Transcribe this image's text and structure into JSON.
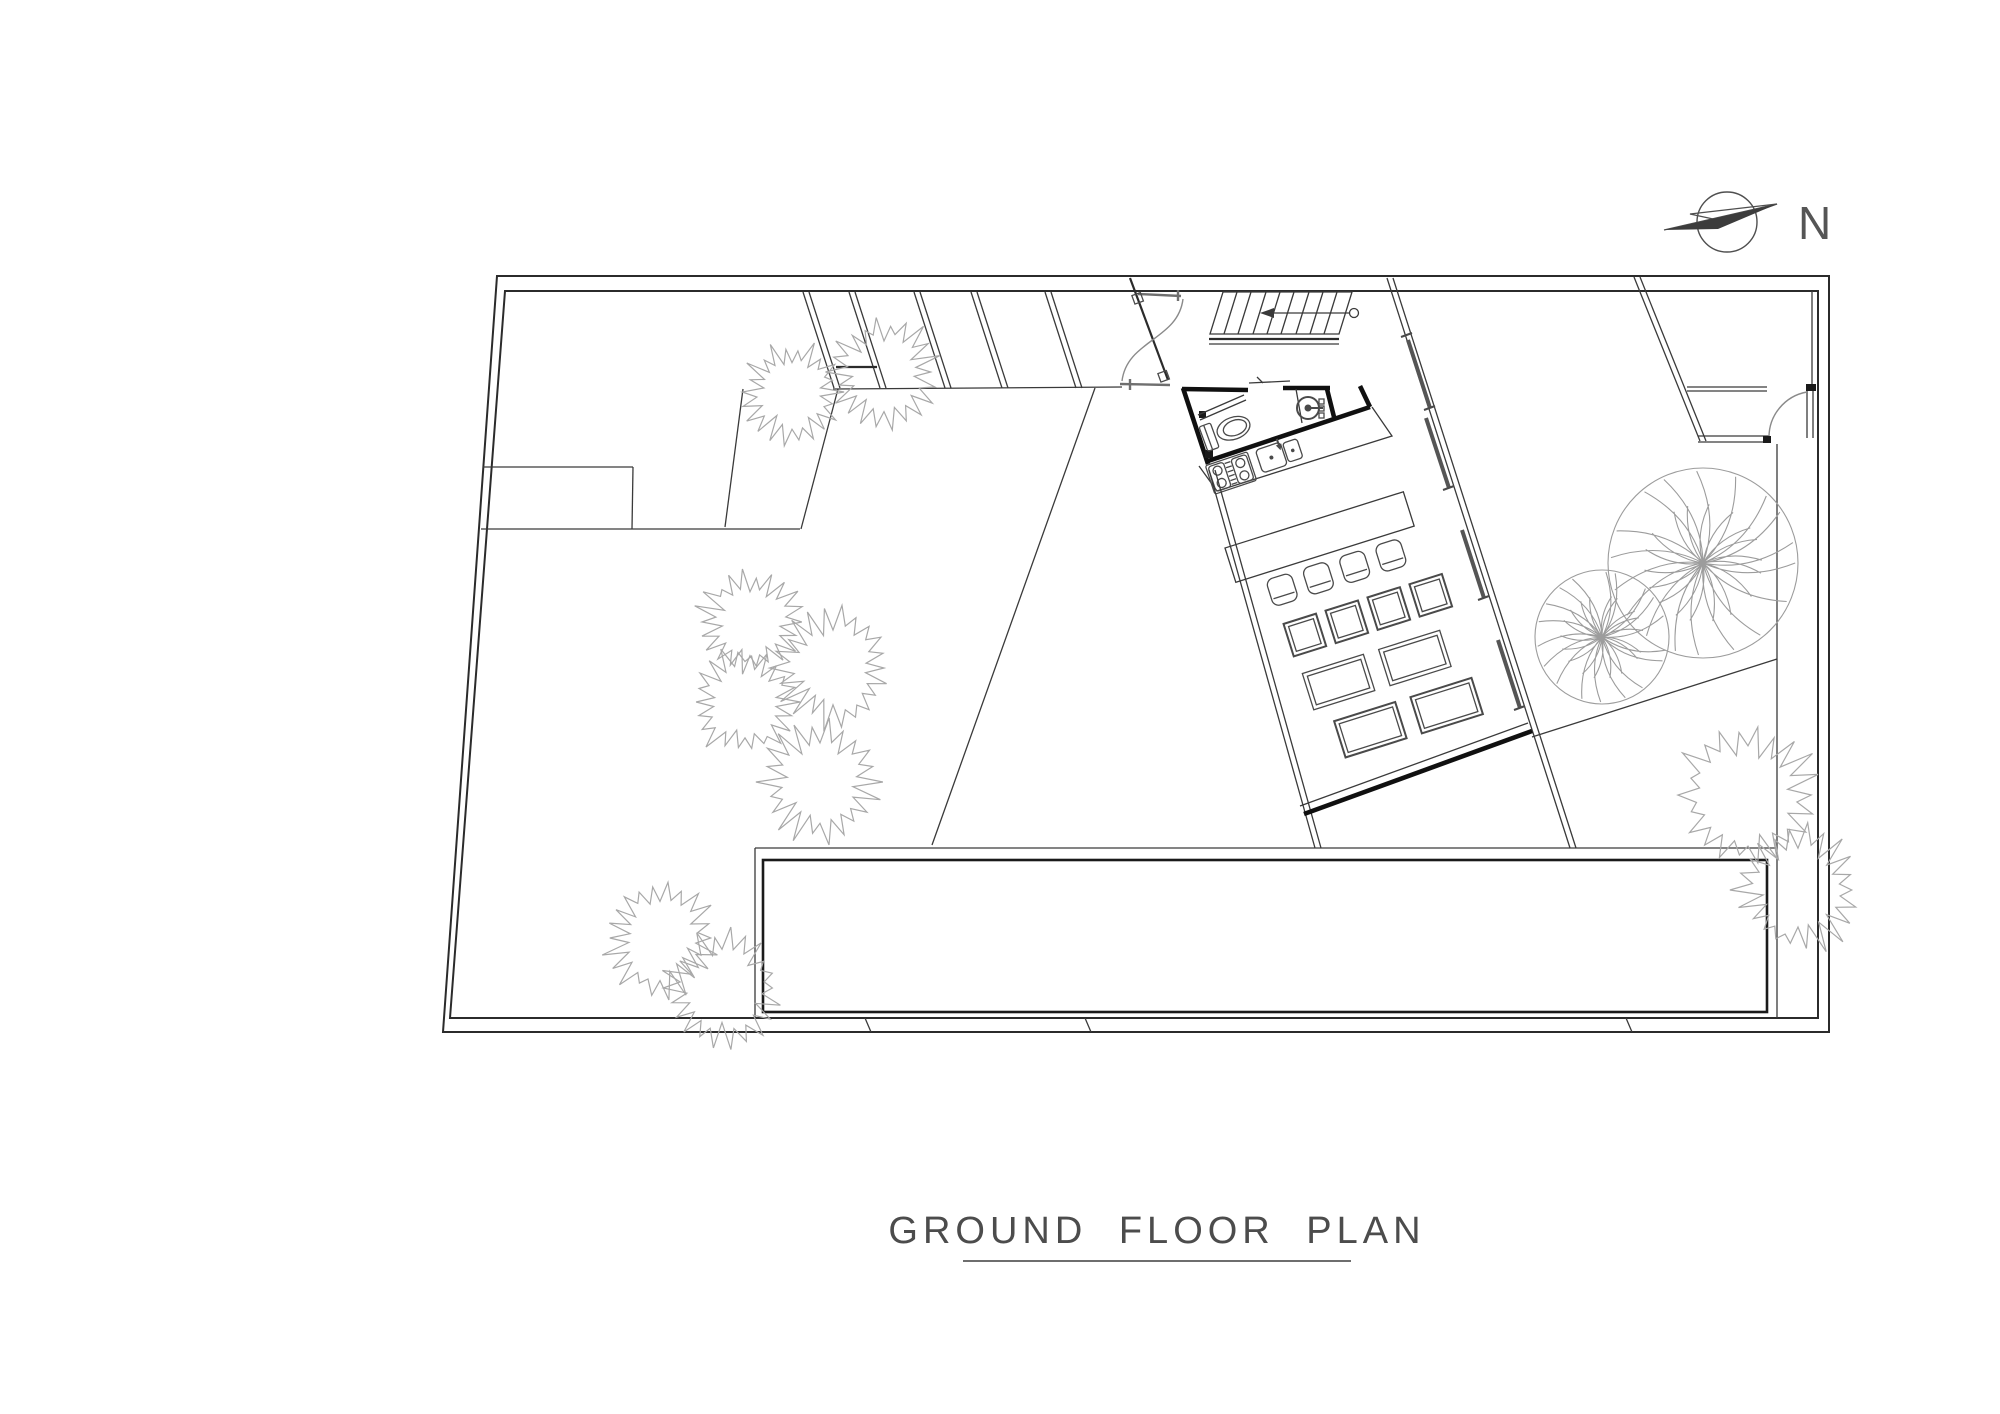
{
  "document": {
    "kind": "architectural floor plan drawing",
    "background_color": "#ffffff",
    "ink_color": "#2b2b2b",
    "heavy_wall_color": "#101010",
    "vegetation_color": "#a8a8a8"
  },
  "title": {
    "text": "GROUND FLOOR PLAN",
    "underlined": true
  },
  "compass": {
    "label": "N",
    "direction": "arrow points left of the N label"
  },
  "plan": {
    "symbols": [
      "north-arrow",
      "perimeter-wall",
      "louver-fin-walls",
      "double-swing-entry-door",
      "staircase-with-direction-arrow",
      "wc-toilet",
      "round-washbasin",
      "double-bowl-kitchen-sink",
      "four-burner-stove",
      "kitchen-counter",
      "bar-counter",
      "bar-stools",
      "square-tables",
      "rectangular-tables",
      "glazed-wall-panels",
      "hinged-door",
      "terrace-court",
      "round-trees",
      "shrubs"
    ]
  }
}
